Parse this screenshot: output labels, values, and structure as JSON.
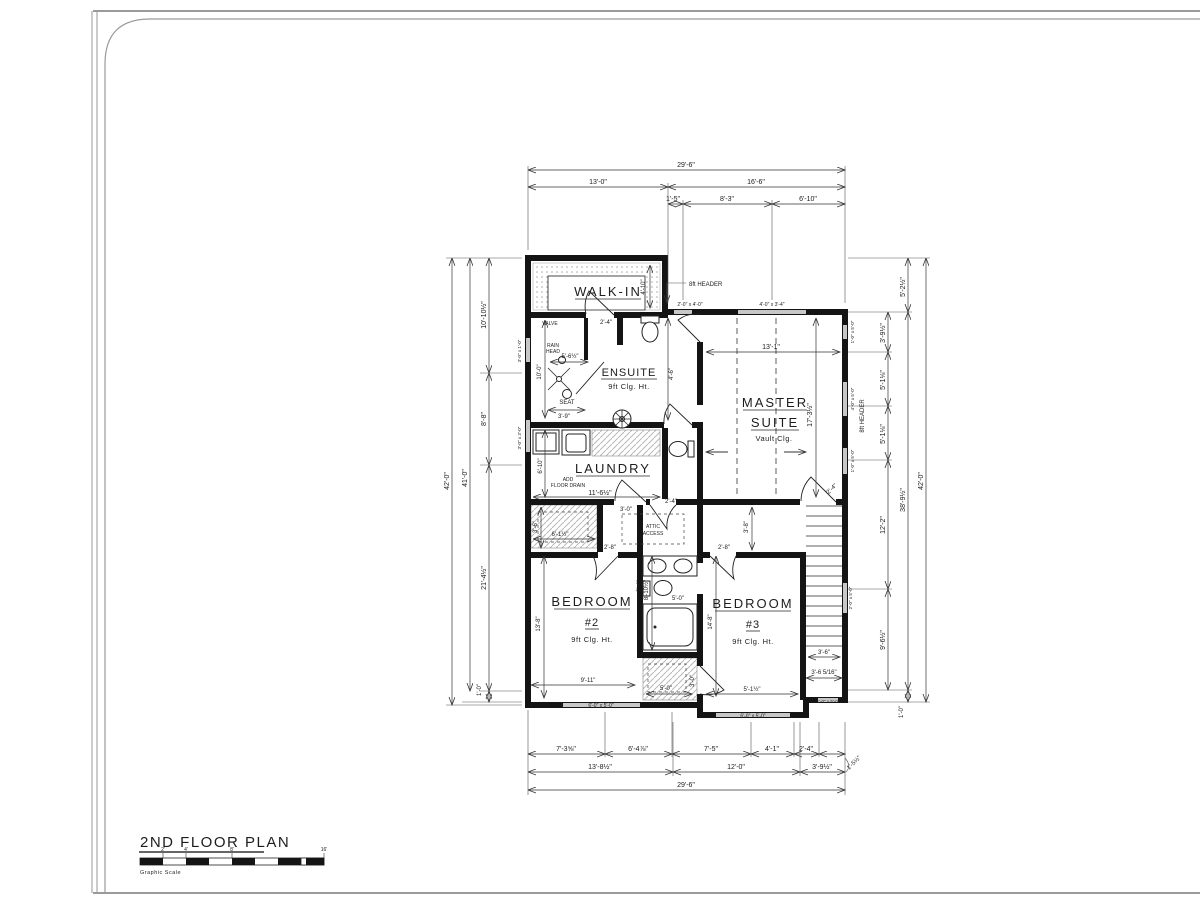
{
  "title_block": {
    "title": "2ND FLOOR PLAN",
    "caption": "Graphic Scale",
    "t1": "2'",
    "t2": "4'",
    "t3": "8'",
    "t4": "16'"
  },
  "rooms": {
    "walkin": {
      "name": "WALK-IN"
    },
    "ensuite": {
      "name": "ENSUITE",
      "clg": "9ft Clg. Ht."
    },
    "master": {
      "l1": "MASTER",
      "l2": "SUITE",
      "clg": "Vault Clg."
    },
    "laundry": {
      "name": "LAUNDRY",
      "n1": "ADD",
      "n2": "FLOOR DRAIN"
    },
    "bed2": {
      "name": "BEDROOM",
      "num": "#2",
      "clg": "9ft Clg. Ht."
    },
    "bed3": {
      "name": "BEDROOM",
      "num": "#3",
      "clg": "9ft Clg. Ht."
    },
    "attic": {
      "l1": "ATTIC",
      "l2": "ACCESS"
    }
  },
  "dims": {
    "top": {
      "overall": "29'-6\"",
      "w_left": "13'-0\"",
      "w_right": "16'-6\"",
      "s1": "1'-5\"",
      "s2": "8'-3\"",
      "s3": "6'-10\""
    },
    "bottom": {
      "s1": "7'-3⅝\"",
      "s2": "6'-4⅞\"",
      "s3": "7'-5\"",
      "s4": "4'-1\"",
      "s5": "2'-4\"",
      "s6": "1'-5½\"",
      "m1": "13'-8½\"",
      "m2": "12'-0\"",
      "m3": "3'-9½\"",
      "overall": "29'-6\""
    },
    "left": {
      "overall": "42'-0\"",
      "inner": "41'-0\"",
      "s1": "10'-10½\"",
      "s2": "8'-8\"",
      "s3": "21'-4½\"",
      "s4": "1'-0\""
    },
    "right": {
      "s1": "5'-2½\"",
      "s2": "3'-9½\"",
      "s3": "5'-1⅛\"",
      "s4": "5'-1⅛\"",
      "s5": "12'-2\"",
      "s6": "9'-6½\"",
      "s7": "1'-0\"",
      "sub": "38'-9½\"",
      "overall": "42'-0\"",
      "header": "8ft HEADER"
    }
  },
  "windows": {
    "top_a": "2'-0\" x 4'-0\"",
    "top_b": "4'-0\" x 3'-4\"",
    "right_a": "1'-0\" x 5'-0\"",
    "right_b": "4'-0\" x 5'-0\"",
    "right_c": "1'-0\" x 5'-0\"",
    "right_d": "2'-0\" x 5'-0\"",
    "bottom_a": "6'-0\" x 5'-0\"",
    "bottom_b": "6'-0\" x 5'-0\"",
    "bottom_c": "1'-0\" x 5'-0\"",
    "left_a": "3'-0\" x 1'-0\"",
    "left_b": "3'-0\" x 3'-0\""
  },
  "interior": {
    "header_top": "8ft HEADER",
    "valve": "VALVE",
    "rain1": "RAIN",
    "rain2": "HEAD",
    "shower_w": "5'-6½\"",
    "seat": "SEAT",
    "seat_d": "3'-9\"",
    "shower_h": "10'-0\"",
    "wc_w": "4'-6\"",
    "walkin_d": "4'-10\"",
    "walkin_door": "2'-4\"",
    "master_w": "13'-1\"",
    "master_h": "17'-3½\"",
    "master_door": "2'-4\"",
    "see_detail": "SEE DETAIL",
    "laundry_w": "11'-6½\"",
    "laundry_h": "6'-10\"",
    "closet_w": "6'-1½\"",
    "closet_h": "3'-6\"",
    "hall_door1": "3'-0\"",
    "hall_door2": "2'-4\"",
    "hall_h": "3'-8\"",
    "bed2_door": "2'-8\"",
    "bed3_door": "2'-8\"",
    "bath_h": "8'-10½\"",
    "bath_w": "5'-0\"",
    "vanity_d": "2'-4\"",
    "bed3_h": "14'-8\"",
    "bed3_w": "5'-1½\"",
    "bed2_h": "13'-8\"",
    "bed2_w": "9'-11\"",
    "bclos_w": "5'-0\"",
    "bclos_door": "3'-0\"",
    "stair_w": "3'-6\"",
    "stair_w2": "3'-6 5/16\""
  }
}
